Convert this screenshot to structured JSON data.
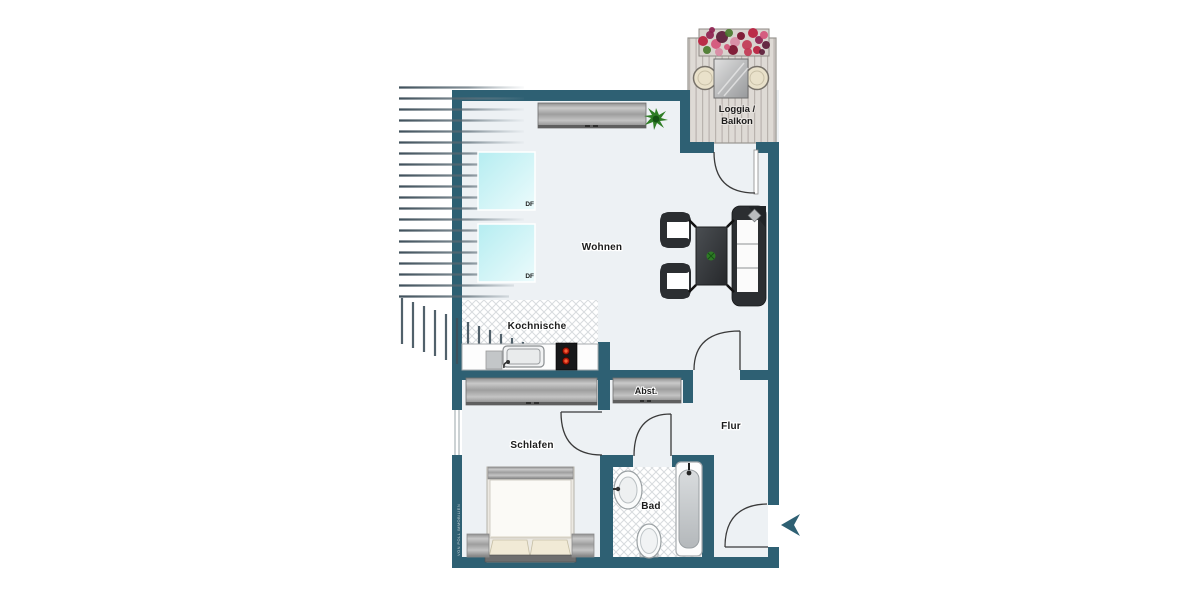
{
  "labels": {
    "wohnen": "Wohnen",
    "kochnische": "Kochnische",
    "schlafen": "Schlafen",
    "bad": "Bad",
    "flur": "Flur",
    "abstellraum": "Abst.",
    "loggia_line1": "Loggia /",
    "loggia_line2": "Balkon",
    "skylight_1": "DF",
    "skylight_2": "DF",
    "watermark": "VON POLL IMMOBILIEN"
  },
  "colors": {
    "wall": "#2e6073",
    "floor": "#edf1f4",
    "outside": "#ffffff",
    "door_arc": "#3a3a3a",
    "roof_hatch": "#3f505b",
    "tile_line": "#d7dbde",
    "skylight": "#b5edf1",
    "deck": "#dedad5",
    "furniture_dark": "#2b2e31",
    "burner_red": "#b5170a",
    "plant_green": "#2e7d25",
    "label_text": "#1c1c1c",
    "flower_palette": [
      "#b81e3e",
      "#8e2150",
      "#d5537a",
      "#5c1b38",
      "#4a7a2e",
      "#d98aa4",
      "#7a0f2d",
      "#c23a55"
    ]
  }
}
